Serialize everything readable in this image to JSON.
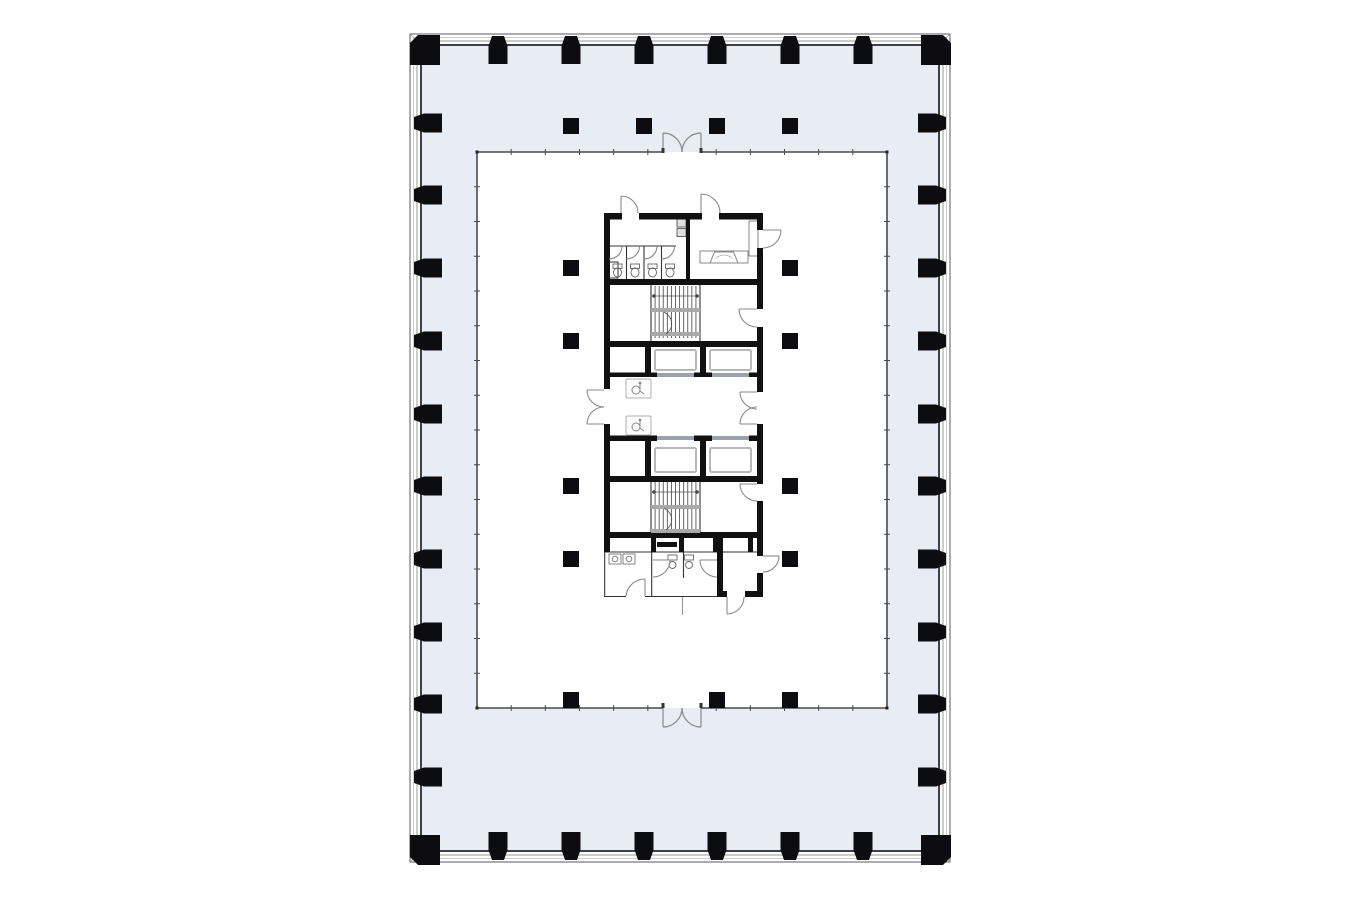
{
  "drawing": {
    "kind": "architectural-floor-plan",
    "canvas": {
      "width": 1360,
      "height": 900,
      "background": "#ffffff"
    },
    "colors": {
      "facade_fill": "#e8ecf5",
      "floor_fill": "#ffffff",
      "outer_line_dark": "#5a5a5a",
      "outer_line_light": "#c4c4c4",
      "outer_line_mid": "#8f8f8f",
      "inner_wall_line": "#2b2b2b",
      "boundary_line": "#4a4a4a",
      "column_fill": "#0d0d11",
      "core_wall": "#111111",
      "door_line": "#8a8a8a",
      "thin_line": "#333333",
      "fixture_line": "#777777",
      "stair_line": "#555555",
      "stair_band": "#a9a9a9",
      "sill": "#9aa3ad",
      "car_outline": "#b8b8b8"
    },
    "outer_wall": {
      "x": 410,
      "y": 34,
      "width": 540,
      "height": 828,
      "band": 12
    },
    "floor_zone": {
      "x": 477,
      "y": 152,
      "width": 410,
      "height": 556
    },
    "entry_doors": [
      {
        "side": "north",
        "x1": 663,
        "x2": 701,
        "type": "double-swing"
      },
      {
        "side": "south",
        "x1": 663,
        "x2": 701,
        "type": "double-swing"
      }
    ],
    "tick_divisions": {
      "horizontal": 12,
      "vertical": 16
    },
    "perimeter_columns": {
      "top_x": [
        498,
        571,
        644,
        717,
        790,
        863
      ],
      "bottom_x": [
        498,
        571,
        644,
        717,
        790,
        863
      ],
      "left_y": [
        123,
        195,
        268,
        341,
        414,
        486,
        559,
        632,
        704,
        777
      ],
      "right_y": [
        123,
        195,
        268,
        341,
        414,
        486,
        559,
        632,
        704,
        777
      ],
      "corners": [
        [
          425,
          50
        ],
        [
          936,
          50
        ],
        [
          425,
          850
        ],
        [
          936,
          850
        ]
      ]
    },
    "interior_columns": {
      "size": 16,
      "plaza_row": {
        "y": 126,
        "x": [
          571,
          644,
          717,
          790
        ]
      },
      "floor": [
        [
          571,
          268
        ],
        [
          790,
          268
        ],
        [
          571,
          341
        ],
        [
          790,
          341
        ],
        [
          571,
          486
        ],
        [
          790,
          486
        ],
        [
          571,
          559
        ],
        [
          790,
          559
        ],
        [
          571,
          700
        ],
        [
          717,
          700
        ],
        [
          790,
          700
        ]
      ]
    },
    "core": {
      "x": 604,
      "y": 213,
      "width": 159,
      "height": 384,
      "stairs": [
        {
          "id": "stair-north",
          "x": 651,
          "y": 286,
          "width": 49,
          "height": 52,
          "treads": 12
        },
        {
          "id": "stair-south",
          "x": 651,
          "y": 482,
          "width": 49,
          "height": 52,
          "treads": 12
        }
      ],
      "facilities": {
        "elevators": 4,
        "stairwells": 2,
        "accessible_wc": 2,
        "toilet_stalls_north": 4,
        "toilet_fixtures_south": 2,
        "sinks_south": 2
      }
    }
  }
}
